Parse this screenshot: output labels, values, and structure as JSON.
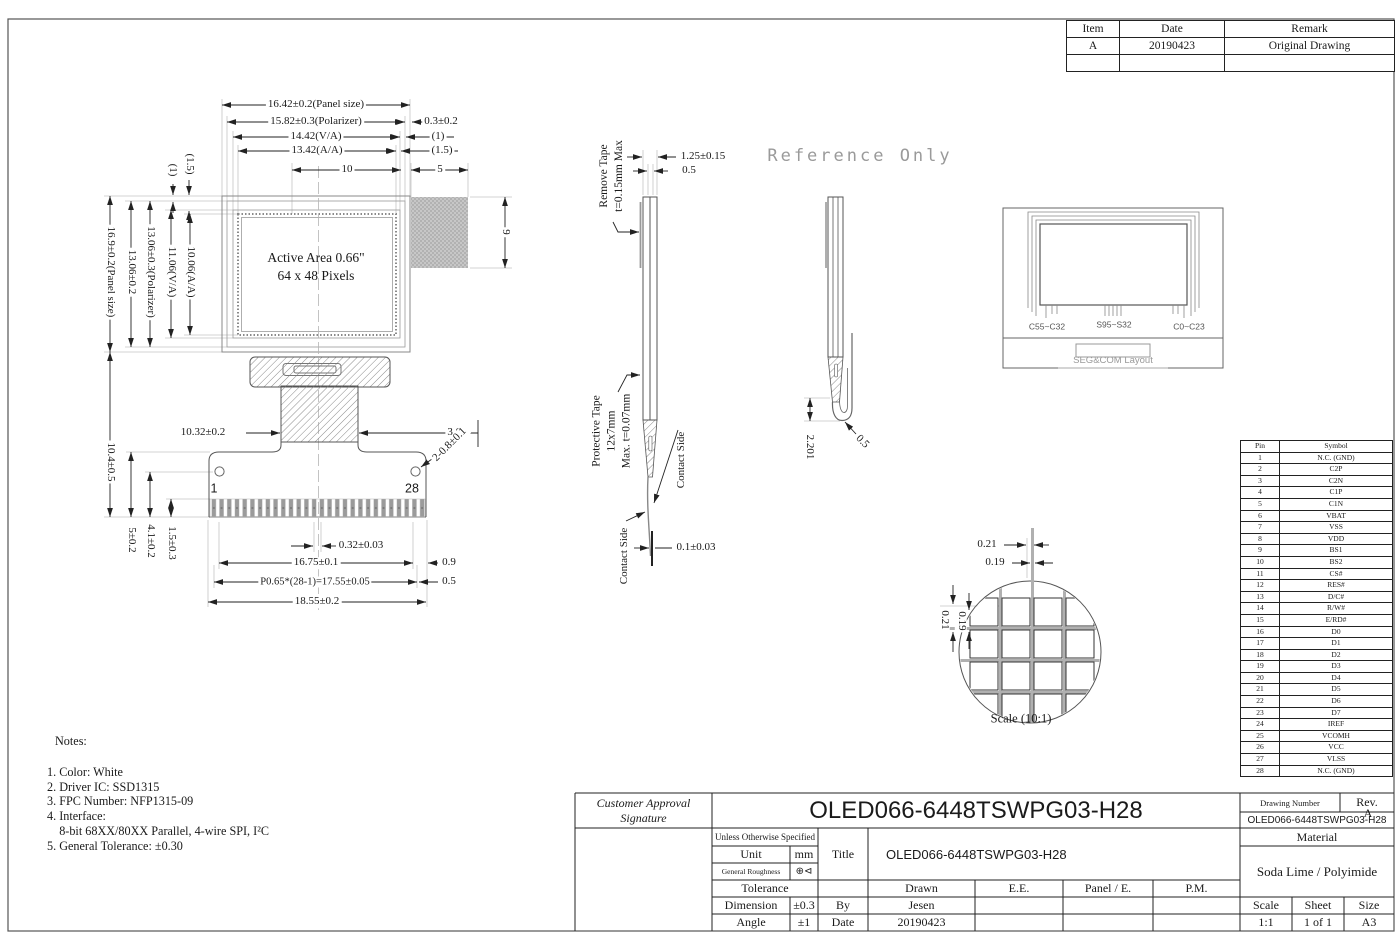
{
  "revision_table": {
    "col_item": "Item",
    "col_date": "Date",
    "col_remark": "Remark",
    "rows": [
      {
        "item": "A",
        "date": "20190423",
        "remark": "Original Drawing"
      },
      {
        "item": "",
        "date": "",
        "remark": ""
      }
    ]
  },
  "front_view": {
    "active_area_line1": "Active Area 0.66\"",
    "active_area_line2": "64 x 48 Pixels",
    "pin_first": "1",
    "pin_last": "28",
    "dim_panel_w": "16.42±0.2(Panel size)",
    "dim_polarizer_w": "15.82±0.3(Polarizer)",
    "dim_va_w": "14.42(V/A)",
    "dim_aa_w": "13.42(A/A)",
    "dim_10": "10",
    "dim_5": "5",
    "dim_03": "0.3±0.2",
    "dim_1": "(1)",
    "dim_15": "(1.5)",
    "dim_9": "9",
    "dim_panel_h": "16.9±0.2(Panel size)",
    "dim_1306": "13.06±0.2",
    "dim_polarizer_h": "13.06±0.3(Polarizer)",
    "dim_va_h": "11.06(V/A)",
    "dim_aa_h": "10.06(A/A)",
    "dim_top_1": "(1)",
    "dim_top_15": "(1.5)",
    "dim_104": "10.4±0.5",
    "dim_5_02": "5±0.2",
    "dim_41": "4.1±0.2",
    "dim_15_03": "1.5±0.3",
    "dim_1032": "10.32±0.2",
    "dim_305": "3.05",
    "dim_holes": "2-0.8±0.1",
    "dim_032": "0.32±0.03",
    "dim_1675": "16.75±0.1",
    "dim_09": "0.9",
    "dim_pitch": "P0.65*(28-1)=17.55±0.05",
    "dim_05": "0.5",
    "dim_1855": "18.55±0.2"
  },
  "side_view1": {
    "remove_tape_l1": "Remove Tape",
    "remove_tape_l2": "t=0.15mm Max",
    "dim_125": "1.25±0.15",
    "dim_05": "0.5",
    "protective_l1": "Protective Tape",
    "protective_l2": "12x7mm",
    "protective_l3": "Max. t=0.07mm",
    "contact_side_right": "Contact Side",
    "contact_side_left": "Contact Side",
    "dim_01": "0.1±0.03"
  },
  "side_view2": {
    "dim_2201": "2.201",
    "dim_05": "0.5"
  },
  "reference_only": "Reference Only",
  "seg_com": {
    "label_left": "C55~C32",
    "label_center": "S95~S32",
    "label_right": "C0~C23",
    "caption": "SEG&COM Layout"
  },
  "detail": {
    "dim_top_021": "0.21",
    "dim_top_019": "0.19",
    "dim_left_021": "0.21",
    "dim_left_019": "0.19",
    "scale_label": "Scale (10:1)"
  },
  "pin_table": {
    "col_pin": "Pin",
    "col_symbol": "Symbol",
    "rows": [
      [
        "1",
        "N.C. (GND)"
      ],
      [
        "2",
        "C2P"
      ],
      [
        "3",
        "C2N"
      ],
      [
        "4",
        "C1P"
      ],
      [
        "5",
        "C1N"
      ],
      [
        "6",
        "VBAT"
      ],
      [
        "7",
        "VSS"
      ],
      [
        "8",
        "VDD"
      ],
      [
        "9",
        "BS1"
      ],
      [
        "10",
        "BS2"
      ],
      [
        "11",
        "CS#"
      ],
      [
        "12",
        "RES#"
      ],
      [
        "13",
        "D/C#"
      ],
      [
        "14",
        "R/W#"
      ],
      [
        "15",
        "E/RD#"
      ],
      [
        "16",
        "D0"
      ],
      [
        "17",
        "D1"
      ],
      [
        "18",
        "D2"
      ],
      [
        "19",
        "D3"
      ],
      [
        "20",
        "D4"
      ],
      [
        "21",
        "D5"
      ],
      [
        "22",
        "D6"
      ],
      [
        "23",
        "D7"
      ],
      [
        "24",
        "IREF"
      ],
      [
        "25",
        "VCOMH"
      ],
      [
        "26",
        "VCC"
      ],
      [
        "27",
        "VLSS"
      ],
      [
        "28",
        "N.C. (GND)"
      ]
    ]
  },
  "notes": {
    "title": "Notes:",
    "items": [
      "1. Color: White",
      "2. Driver IC: SSD1315",
      "3. FPC Number: NFP1315-09",
      "4. Interface:",
      "    8-bit 68XX/80XX Parallel, 4-wire SPI, I²C",
      "5. General Tolerance: ±0.30"
    ]
  },
  "title_block": {
    "customer_l1": "Customer Approval",
    "customer_l2": "Signature",
    "main_title": "OLED066-6448TSWPG03-H28",
    "unless": "Unless Otherwise Specified",
    "unit_label": "Unit",
    "unit_value": "mm",
    "roughness_label": "General Roughness",
    "roughness_symbol": "⊕⊲",
    "tolerance_label": "Tolerance",
    "dimension_label": "Dimension",
    "dimension_value": "±0.3",
    "angle_label": "Angle",
    "angle_value": "±1",
    "title_label": "Title",
    "title_value": "OLED066-6448TSWPG03-H28",
    "by_label": "By",
    "by_value": "Jesen",
    "date_label": "Date",
    "date_value": "20190423",
    "drawn_label": "Drawn",
    "ee_label": "E.E.",
    "panel_e_label": "Panel / E.",
    "pm_label": "P.M.",
    "drawing_number_label": "Drawing Number",
    "rev_label": "Rev.",
    "rev_value": "A",
    "drawing_number_value": "OLED066-6448TSWPG03-H28",
    "material_label": "Material",
    "material_value": "Soda Lime / Polyimide",
    "scale_label": "Scale",
    "sheet_label": "Sheet",
    "size_label": "Size",
    "scale_value": "1:1",
    "sheet_value": "1 of 1",
    "size_value": "A3"
  }
}
